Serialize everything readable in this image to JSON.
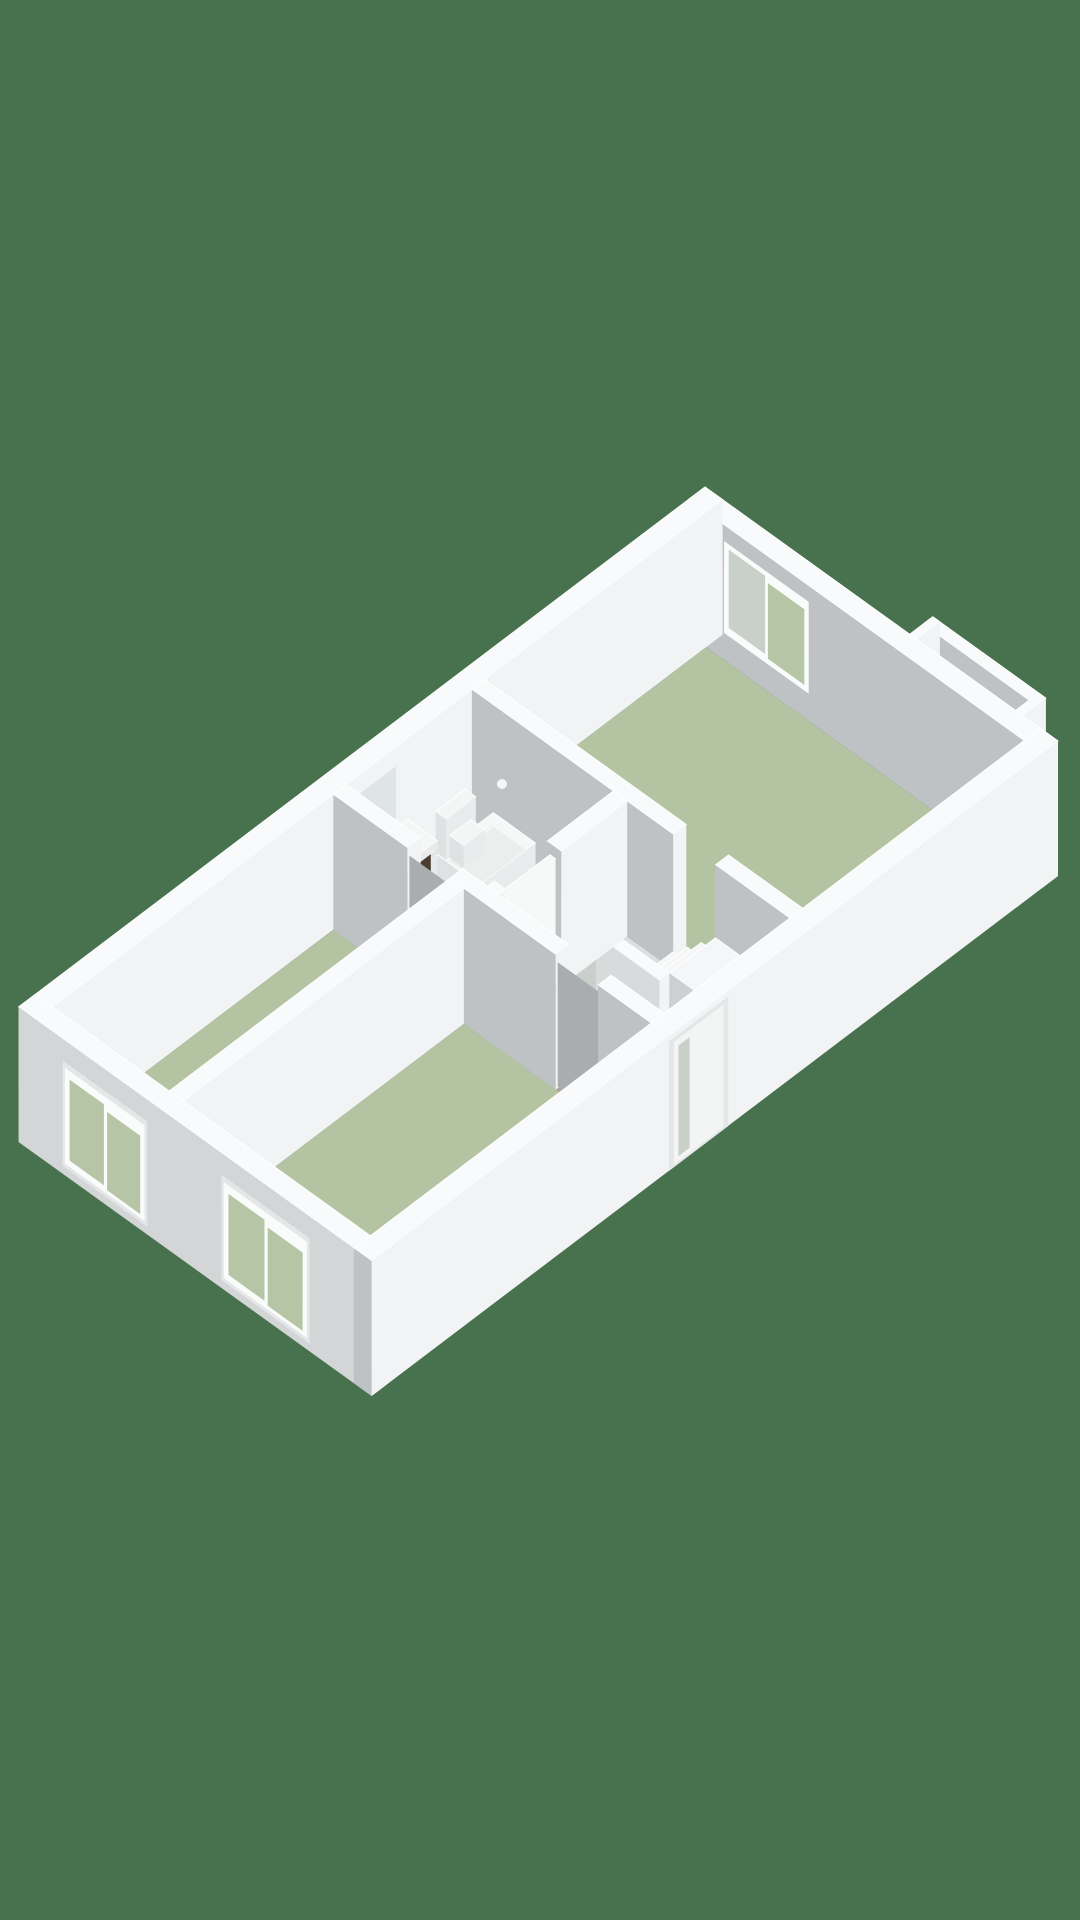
{
  "scene": {
    "name": "apartment-3d-floor-plan",
    "view": "isometric-3d-render",
    "canvas": {
      "width": 1080,
      "height": 1920
    }
  },
  "projection": {
    "origin": [
      705,
      622
    ],
    "u_axis": [
      3.53,
      2.54
    ],
    "v_axis": [
      -3.3,
      2.5
    ],
    "wall_height_px": 135,
    "plan_units": {
      "width_u": 100,
      "length_v": 208,
      "wall_thickness": 5
    }
  },
  "colors": {
    "background": "#48714E",
    "top": "#f9fafb",
    "topStroke": "#ffffff",
    "faceU": "#f2f3f5",
    "faceV": "#bfc2c5",
    "extSW": "#d3d5d7",
    "bayBack": "#edeff1",
    "pocketTop": "#e2e4e5",
    "pocketFu": "#e6e8e9",
    "pocketFv": "#d8dadb",
    "floorSage": "#b4c3a1",
    "floorBath": "#e8e9ea",
    "floorHall": "#dcdee0",
    "floorEntry": "#b2a492",
    "frame": "#fafbfb",
    "frameTrim": "#e4e6e7",
    "glass": "#b6c5a5",
    "glassGray": "#c9cfc9",
    "glassScreen": "rgba(245,248,248,0.55)",
    "screenEdge": "#eef2f2",
    "mirror": "#dfe4e6",
    "doorway": "#a9adb0",
    "doorLeaf": "#f7f8f8",
    "handle": "#a6abae",
    "recess": "#e4e6e7",
    "leafOut": "#f3f4f4",
    "cabinet": "#4a3e30",
    "cabinetSide": "#3e3427",
    "counter": "#f5f6f6",
    "counterFu": "#e9ebeb",
    "counterFv": "#dde0e1",
    "tubTop": "#f6f8f8",
    "tubBasin": "#eceeee",
    "tubSide": "#e9ebec",
    "tubFront": "#dfe2e3",
    "fixture": "#f4f6f6",
    "chrome": "#9aa0a4",
    "speckle": "#c9cfcb",
    "railFv": "#d8dadc",
    "treadTop": "#f5f6f7",
    "treadFu": "#e8eaec",
    "treadFv": "#cdd0d3"
  },
  "rooms": [
    {
      "name": "living-area",
      "floor": "floorSage",
      "features": [
        "window-ne",
        "bay-niche-windows"
      ]
    },
    {
      "name": "bathroom",
      "floor": "floorBath",
      "features": [
        "bathtub",
        "vanity-sink",
        "toilet",
        "shower-screen",
        "mirror"
      ]
    },
    {
      "name": "hallway-entry",
      "floor": "floorHall",
      "entry_patch": "floorEntry",
      "features": [
        "staircase",
        "stairwell-void",
        "entry-door"
      ]
    },
    {
      "name": "room-1",
      "floor": "floorSage",
      "features": [
        "window-sw-1",
        "doorway"
      ]
    },
    {
      "name": "room-2",
      "floor": "floorSage",
      "features": [
        "window-sw-2",
        "doorway"
      ]
    }
  ],
  "items": [
    {
      "n": "bay-back-wall",
      "t": "face",
      "plane": "v",
      "at": 0.02,
      "a": [
        58,
        90
      ],
      "z": [
        0,
        1
      ],
      "f": "bayBack"
    },
    {
      "n": "bay-back-window-frame",
      "t": "face",
      "plane": "v",
      "at": 0.01,
      "a": [
        74,
        88
      ],
      "z": [
        0.1,
        0.68
      ],
      "f": "frame"
    },
    {
      "n": "bay-back-window-glass",
      "t": "face",
      "plane": "v",
      "at": 0,
      "a": [
        75.2,
        86.8
      ],
      "z": [
        0.15,
        0.62
      ],
      "f": "glassGray"
    },
    {
      "n": "bay-pocket-floor",
      "t": "box",
      "r": [
        60,
        -4,
        88,
        0
      ],
      "z": [
        0,
        0.1
      ],
      "top": "pocketTop",
      "fu": "pocketFu",
      "fv": "pocketFv"
    },
    {
      "n": "bay-outer-wall",
      "t": "box",
      "r": [
        58,
        -7,
        90,
        -4
      ],
      "z": [
        0,
        1
      ]
    },
    {
      "n": "bay-outer-window-frame",
      "t": "face",
      "plane": "v",
      "at": -4.02,
      "a": [
        62,
        78
      ],
      "z": [
        0.18,
        0.8
      ],
      "f": "frame"
    },
    {
      "n": "bay-outer-window-glass",
      "t": "face",
      "plane": "v",
      "at": -4.04,
      "a": [
        63.4,
        76.6
      ],
      "z": [
        0.24,
        0.74
      ],
      "f": "glass"
    },
    {
      "n": "bay-side-wall-left",
      "t": "box",
      "r": [
        58,
        -7,
        60,
        0
      ],
      "z": [
        0,
        1
      ]
    },
    {
      "n": "bay-side-wall-right",
      "t": "box",
      "r": [
        88,
        -7,
        90,
        0
      ],
      "z": [
        0,
        1
      ]
    },
    {
      "n": "exterior-wall-ne",
      "t": "box",
      "r": [
        0,
        0,
        100,
        5
      ],
      "z": [
        0,
        1
      ]
    },
    {
      "n": "exterior-wall-nw",
      "t": "box",
      "r": [
        0,
        0,
        5,
        208
      ],
      "z": [
        0,
        1
      ]
    },
    {
      "n": "living-room-floor",
      "t": "floor",
      "r": [
        5,
        5,
        95,
        72
      ],
      "f": "floorSage"
    },
    {
      "n": "living-window-frame",
      "t": "face",
      "plane": "v",
      "at": 4.95,
      "a": [
        10,
        34
      ],
      "z": [
        0.2,
        0.88
      ],
      "f": "frame"
    },
    {
      "n": "living-window-glass-left",
      "t": "face",
      "plane": "v",
      "at": 4.9,
      "a": [
        11.3,
        21.6
      ],
      "z": [
        0.26,
        0.84
      ],
      "f": "glassGray"
    },
    {
      "n": "living-window-glass-right",
      "t": "face",
      "plane": "v",
      "at": 4.9,
      "a": [
        22.4,
        32.7
      ],
      "z": [
        0.24,
        0.8
      ],
      "f": "glass"
    },
    {
      "n": "wall-living-hall-left",
      "t": "box",
      "r": [
        5,
        72,
        62,
        76
      ],
      "z": [
        0,
        1
      ]
    },
    {
      "n": "wall-living-hall-right",
      "t": "box",
      "r": [
        74,
        72,
        95,
        76
      ],
      "z": [
        0,
        1
      ]
    },
    {
      "n": "shower-mixer",
      "t": "dot",
      "p": [
        14,
        76.5,
        0.48
      ],
      "rad": 5,
      "f": "fixture"
    },
    {
      "n": "bathroom-floor",
      "t": "floor",
      "r": [
        5,
        76,
        45,
        118
      ],
      "f": "floorBath"
    },
    {
      "n": "hallway-floor",
      "t": "floor",
      "r": [
        49,
        76,
        95,
        118
      ],
      "f": "floorHall"
    },
    {
      "n": "entry-floor",
      "t": "floor",
      "r": [
        49,
        96,
        78,
        118
      ],
      "f": "floorEntry"
    },
    {
      "n": "stairwell-lower-floor",
      "t": "poly",
      "pts": [
        [
          49,
          78
        ],
        [
          56,
          78
        ],
        [
          56,
          93
        ],
        [
          49,
          93
        ]
      ],
      "f": "speckle"
    },
    {
      "n": "stairwell-void",
      "t": "poly",
      "pts": [
        [
          55,
          78
        ],
        [
          62,
          78
        ],
        [
          62,
          95
        ],
        [
          57,
          95
        ],
        [
          55,
          88
        ]
      ],
      "f": "background"
    },
    {
      "n": "stair-tread-1",
      "t": "box",
      "r": [
        62,
        76,
        66,
        90
      ],
      "z": [
        0,
        0.13
      ],
      "top": "treadTop",
      "fu": "treadFu",
      "fv": "treadFv"
    },
    {
      "n": "stair-tread-2",
      "t": "box",
      "r": [
        66,
        76,
        70,
        90
      ],
      "z": [
        0,
        0.24
      ],
      "top": "treadTop",
      "fu": "treadFu",
      "fv": "treadFv"
    },
    {
      "n": "stair-tread-3",
      "t": "box",
      "r": [
        70,
        76,
        74,
        90
      ],
      "z": [
        0,
        0.35
      ],
      "top": "treadTop",
      "fu": "treadFu",
      "fv": "treadFv"
    },
    {
      "n": "stair-landing",
      "t": "box",
      "r": [
        74,
        76,
        88,
        90
      ],
      "z": [
        0,
        0.46
      ],
      "top": "treadTop",
      "fu": "treadFu",
      "fv": "treadFv"
    },
    {
      "n": "stair-parapet",
      "t": "box",
      "r": [
        56,
        90,
        74,
        93
      ],
      "z": [
        0,
        0.46
      ],
      "fv": "railFv"
    },
    {
      "n": "bathtub",
      "t": "box",
      "r": [
        12,
        77,
        24,
        94
      ],
      "z": [
        0,
        0.24
      ],
      "top": "tubTop",
      "fu": "tubSide",
      "fv": "tubFront"
    },
    {
      "n": "bathtub-basin",
      "t": "flat",
      "r": [
        13.5,
        78.5,
        22.5,
        92
      ],
      "z": 0.19,
      "f": "tubBasin"
    },
    {
      "n": "toilet-tank",
      "t": "box",
      "r": [
        5,
        78,
        8,
        87
      ],
      "z": [
        0,
        0.3
      ],
      "top": "fixture",
      "fu": "tubSide",
      "fv": "tubFront"
    },
    {
      "n": "toilet-bowl",
      "t": "box",
      "r": [
        8,
        79.5,
        12,
        86
      ],
      "z": [
        0,
        0.16
      ],
      "top": "fixture",
      "fu": "tubSide",
      "fv": "tubFront"
    },
    {
      "n": "vanity-cabinet",
      "t": "box",
      "r": [
        6,
        97,
        13,
        116
      ],
      "z": [
        0,
        0.36
      ],
      "top": "cabinet",
      "fu": "cabinet",
      "fv": "cabinetSide"
    },
    {
      "n": "vanity-counter",
      "t": "box",
      "r": [
        5.5,
        96,
        14,
        117
      ],
      "z": [
        0.36,
        0.42
      ],
      "top": "counter",
      "fu": "counterFu",
      "fv": "counterFv"
    },
    {
      "n": "sink-basin",
      "t": "flat",
      "r": [
        6.5,
        101,
        12.5,
        111
      ],
      "z": 0.42,
      "f": "counterFu"
    },
    {
      "n": "sink-faucet",
      "t": "dot",
      "p": [
        6.8,
        106,
        0.5
      ],
      "rad": 5,
      "f": "chrome"
    },
    {
      "n": "vanity-mirror",
      "t": "face",
      "plane": "u",
      "at": 5.05,
      "a": [
        99,
        115
      ],
      "z": [
        0.48,
        0.86
      ],
      "f": "mirror"
    },
    {
      "n": "shower-screen",
      "t": "face",
      "plane": "v",
      "at": 112.5,
      "a": [
        5,
        21
      ],
      "z": [
        0.04,
        0.78
      ],
      "f": "glassScreen",
      "s": "screenEdge"
    },
    {
      "n": "wall-bath-hall-a",
      "t": "box",
      "r": [
        45,
        76,
        49,
        96
      ],
      "z": [
        0,
        1
      ]
    },
    {
      "n": "wall-bath-hall-b",
      "t": "box",
      "r": [
        45,
        112,
        49,
        118
      ],
      "z": [
        0,
        1
      ]
    },
    {
      "n": "bathroom-door",
      "t": "box",
      "r": [
        46.2,
        96.4,
        47.8,
        111.6
      ],
      "z": [
        0,
        0.93
      ],
      "top": "doorLeaf",
      "fu": "doorLeaf",
      "fv": "treadFu"
    },
    {
      "n": "bathroom-door-handle",
      "t": "dot",
      "p": [
        47.9,
        108.5,
        0.5
      ],
      "rad": 4,
      "f": "handle"
    },
    {
      "n": "wall-hall-rooms-a",
      "t": "box",
      "r": [
        5,
        114,
        26,
        118
      ],
      "z": [
        0,
        1
      ]
    },
    {
      "n": "doorway-room-1",
      "t": "face",
      "plane": "v",
      "at": 117.6,
      "a": [
        26.2,
        37.8
      ],
      "z": [
        0.02,
        0.94
      ],
      "f": "doorway"
    },
    {
      "n": "wall-hall-rooms-b",
      "t": "box",
      "r": [
        38,
        114,
        68,
        118
      ],
      "z": [
        0,
        1
      ]
    },
    {
      "n": "doorway-room-2",
      "t": "face",
      "plane": "v",
      "at": 117.6,
      "a": [
        68.2,
        79.8
      ],
      "z": [
        0.02,
        0.94
      ],
      "f": "doorway"
    },
    {
      "n": "wall-hall-rooms-c",
      "t": "box",
      "r": [
        80,
        114,
        95,
        118
      ],
      "z": [
        0,
        1
      ]
    },
    {
      "n": "room-1-floor",
      "t": "floor",
      "r": [
        5,
        118,
        38,
        203
      ],
      "f": "floorSage"
    },
    {
      "n": "room-2-floor",
      "t": "floor",
      "r": [
        42,
        118,
        95,
        203
      ],
      "f": "floorSage"
    },
    {
      "n": "wall-room-divider",
      "t": "box",
      "r": [
        38,
        118,
        42,
        203
      ],
      "z": [
        0,
        1
      ]
    },
    {
      "n": "exterior-wall-sw",
      "t": "box",
      "r": [
        0,
        203,
        100,
        208
      ],
      "z": [
        0,
        1
      ],
      "fv": "extSW"
    },
    {
      "n": "sw-window-1-trim",
      "t": "face",
      "plane": "v",
      "at": 208.05,
      "a": [
        12.5,
        36.5
      ],
      "z": [
        0.06,
        0.84
      ],
      "f": "frameTrim"
    },
    {
      "n": "sw-window-1-frame",
      "t": "face",
      "plane": "v",
      "at": 208.1,
      "a": [
        13.2,
        35.8
      ],
      "z": [
        0.09,
        0.8
      ],
      "f": "frame"
    },
    {
      "n": "sw-window-1-glass-left",
      "t": "face",
      "plane": "v",
      "at": 208.15,
      "a": [
        14.6,
        24.3
      ],
      "z": [
        0.14,
        0.74
      ],
      "f": "glass"
    },
    {
      "n": "sw-window-1-glass-right",
      "t": "face",
      "plane": "v",
      "at": 208.15,
      "a": [
        25.2,
        34.6
      ],
      "z": [
        0.12,
        0.7
      ],
      "f": "glass"
    },
    {
      "n": "sw-window-2-trim",
      "t": "face",
      "plane": "v",
      "at": 208.05,
      "a": [
        57.5,
        82.5
      ],
      "z": [
        0.06,
        0.84
      ],
      "f": "frameTrim"
    },
    {
      "n": "sw-window-2-frame",
      "t": "face",
      "plane": "v",
      "at": 208.1,
      "a": [
        58.2,
        81.8
      ],
      "z": [
        0.09,
        0.8
      ],
      "f": "frame"
    },
    {
      "n": "sw-window-2-glass-left",
      "t": "face",
      "plane": "v",
      "at": 208.15,
      "a": [
        59.6,
        69.8
      ],
      "z": [
        0.14,
        0.74
      ],
      "f": "glass"
    },
    {
      "n": "sw-window-2-glass-right",
      "t": "face",
      "plane": "v",
      "at": 208.15,
      "a": [
        70.7,
        80.6
      ],
      "z": [
        0.12,
        0.7
      ],
      "f": "glass"
    },
    {
      "n": "exterior-wall-se",
      "t": "box",
      "r": [
        95,
        0,
        100,
        208
      ],
      "z": [
        0,
        1
      ]
    },
    {
      "n": "entry-door-recess",
      "t": "face",
      "plane": "u",
      "at": 100.05,
      "a": [
        100,
        118
      ],
      "z": [
        0,
        0.96
      ],
      "f": "recess"
    },
    {
      "n": "entry-door-leaf",
      "t": "face",
      "plane": "u",
      "at": 100.1,
      "a": [
        101.5,
        116.5
      ],
      "z": [
        0.02,
        0.93
      ],
      "f": "leafOut"
    },
    {
      "n": "entry-door-glass",
      "t": "face",
      "plane": "u",
      "at": 100.15,
      "a": [
        111.8,
        115.2
      ],
      "z": [
        0.06,
        0.88
      ],
      "f": "glassGray"
    }
  ]
}
